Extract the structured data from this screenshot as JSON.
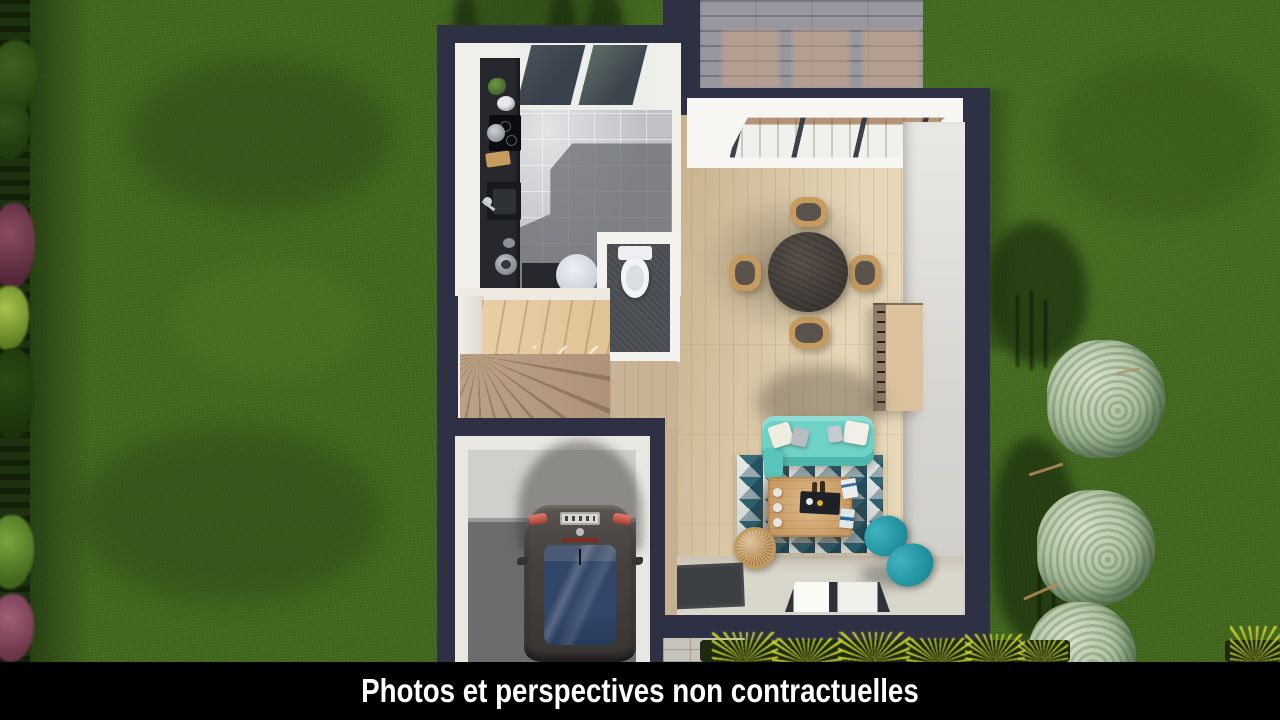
{
  "caption": {
    "text": "Photos et perspectives non contractuelles"
  },
  "palette": {
    "wall": "#2d3143",
    "grass": "#41661f",
    "hedge": "#1c3110",
    "wood": "#e6d7b8",
    "tile": "#c0c1c6",
    "counter": "#26282e",
    "sofa": "#6fd2c7",
    "armchair": "#1b8b97",
    "rug1": "#1c4a5c",
    "rug2": "#93a9ae",
    "rug3": "#e4e8e5",
    "rug4": "#2b6173",
    "stairs1": "#e7cfa6",
    "stairs2": "#ae937a",
    "paving": "#97979f",
    "terrace-warm": "#cda587",
    "car-body": "#474340",
    "car-glass": "#324669",
    "gfloor1": "#d0cfcb",
    "gfloor2": "#6a6c6e",
    "tree": "#b2c6a6",
    "caption-bg": "#000000",
    "caption-fg": "#ffffff"
  },
  "scene": {
    "type": "top-down 3d floor plan render",
    "elements": [
      "lawn",
      "hedge",
      "flowering-shrubs",
      "trees",
      "terrace-decking",
      "house",
      "kitchen",
      "kitchen-counter",
      "kitchen-window",
      "wc",
      "toilet",
      "staircase",
      "garage",
      "car",
      "living-dining-room",
      "bay-window",
      "dining-table",
      "dining-chairs",
      "sideboard",
      "sofa",
      "rug",
      "coffee-table",
      "rattan-side-table",
      "armchair",
      "doormat",
      "floor-window",
      "ornamental-grasses",
      "stone-paver"
    ]
  }
}
